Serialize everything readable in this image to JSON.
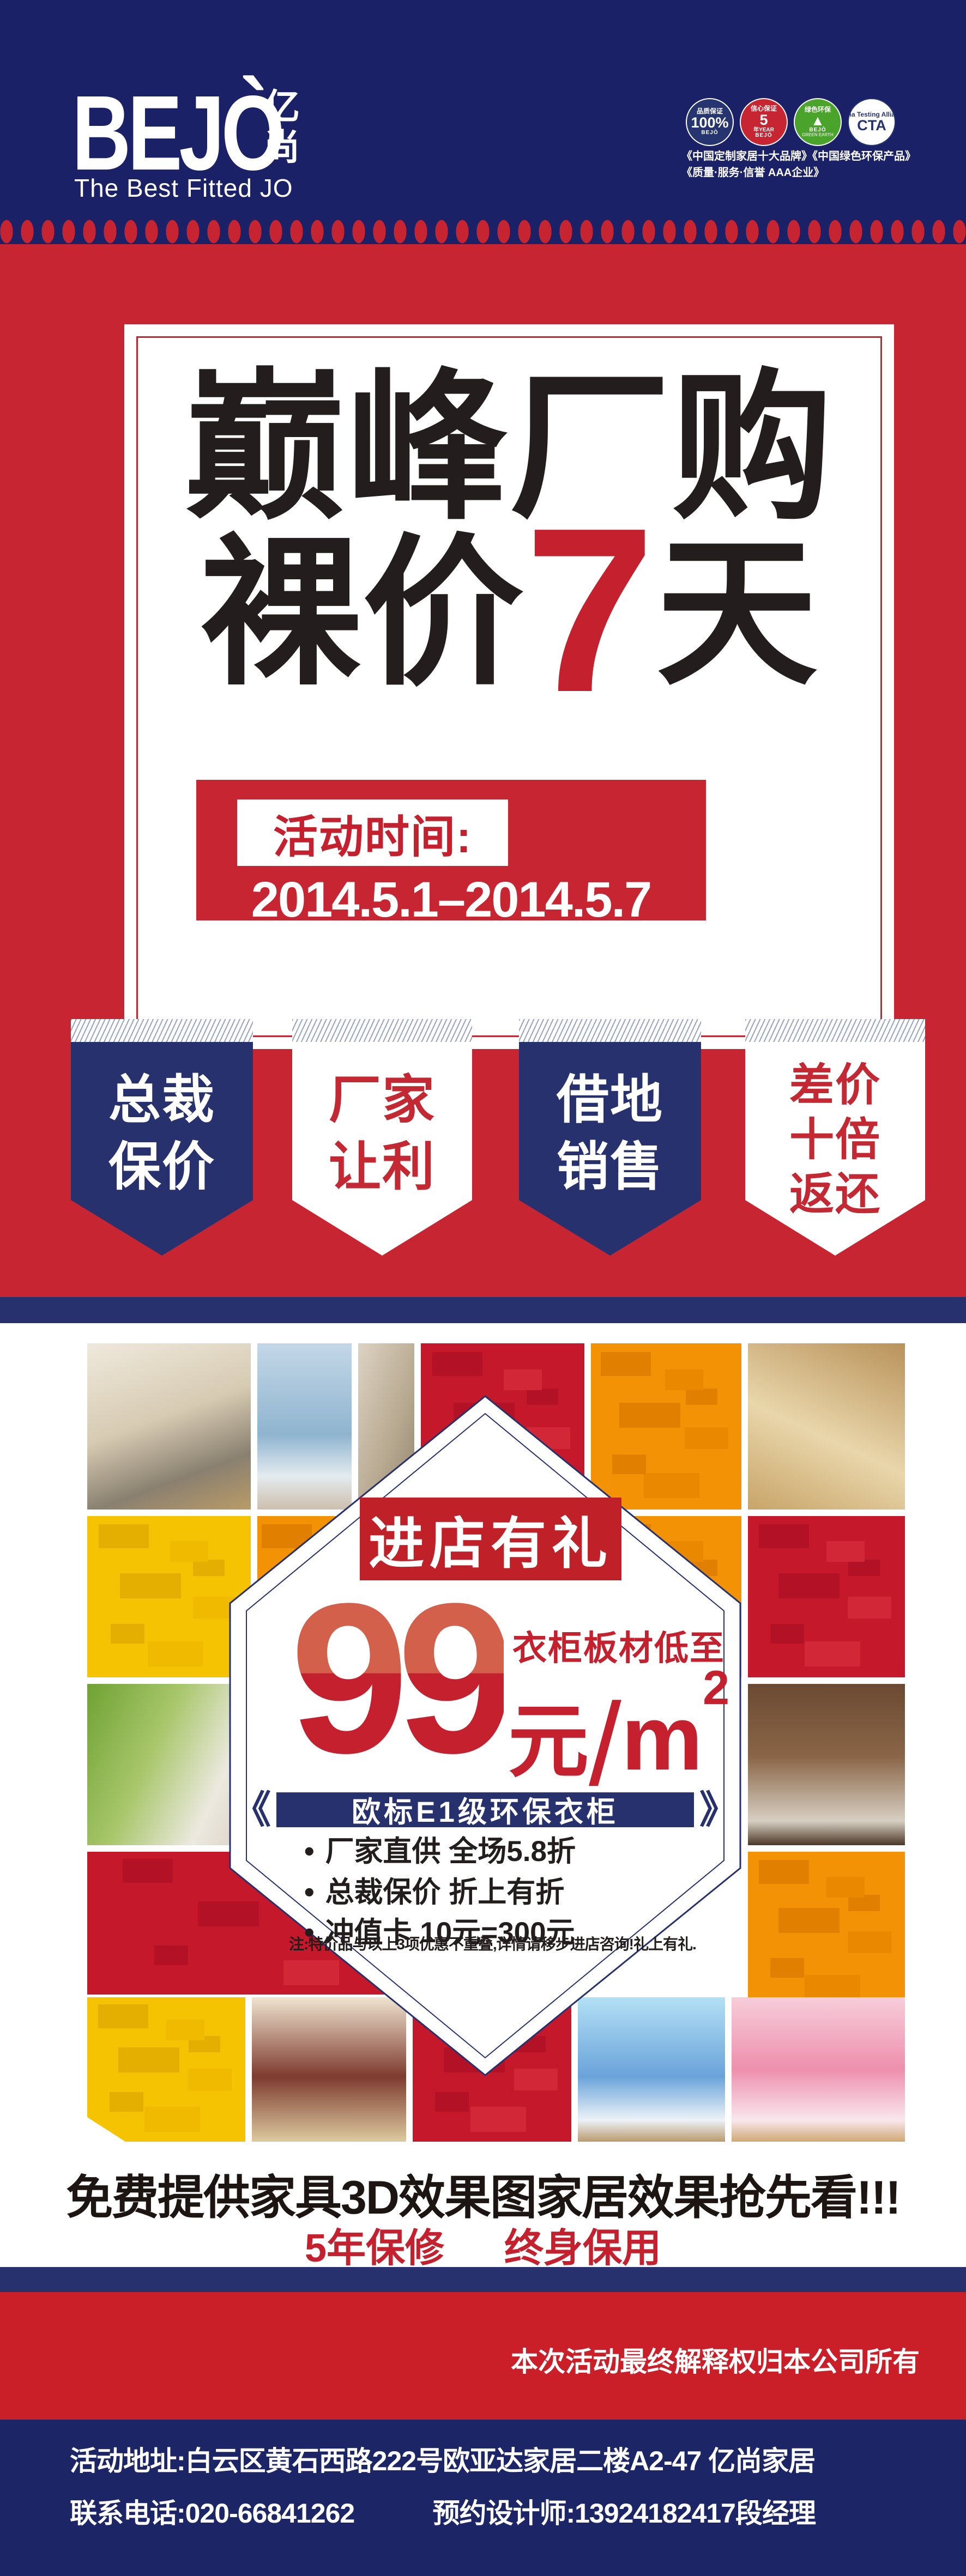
{
  "colors": {
    "navy": "#1b2166",
    "pennant_navy": "#27316e",
    "red": "#c62531",
    "accent_red": "#c5202e",
    "price_top": "#d2604a",
    "yellow": "#f6c303",
    "orange": "#f39204",
    "mosaic_red": "#c5182b",
    "green_badge": "#4aa32b"
  },
  "header": {
    "logo": {
      "word": "BEJÒ",
      "cn_top": "亿",
      "cn_bottom": "尚",
      "slogan": "The Best Fitted JO"
    },
    "badges": {
      "b1": {
        "top": "品质保证",
        "main": "100%",
        "brand": "BEJÒ"
      },
      "b2": {
        "top": "信心保证",
        "main": "5",
        "suffix": "年YEAR",
        "brand": "BEJÒ"
      },
      "b3": {
        "top": "绿色环保",
        "tree": "▲",
        "brand": "BEJÒ",
        "bottom": "GREEN EARTH"
      },
      "b4": {
        "top": "China Testing Alliance",
        "main": "CTA"
      }
    },
    "creds": {
      "line1": "《中国定制家居十大品牌》《中国绿色环保产品》",
      "line2": "《质量·服务·信誉 AAA企业》"
    }
  },
  "hero": {
    "title_line1": "巅峰厂购",
    "title_line2_pre": "裸价",
    "title_line2_num": "7",
    "title_line2_post": "天",
    "time_label": "活动时间:",
    "dates": "2014.5.1–2014.5.7"
  },
  "pennants": [
    {
      "line1": "总裁",
      "line2": "保价",
      "line3": ""
    },
    {
      "line1": "厂家",
      "line2": "让利",
      "line3": ""
    },
    {
      "line1": "借地",
      "line2": "销售",
      "line3": ""
    },
    {
      "line1": "差价",
      "line2": "十倍",
      "line3": "返还"
    }
  ],
  "offer": {
    "banner": "进店有礼",
    "price": "99",
    "tagline": "衣柜板材低至",
    "yuan": "元",
    "slash": "/",
    "meter": "m",
    "sup": "2",
    "quote_left": "《",
    "bar": "欧标E1级环保衣柜",
    "quote_right": "》",
    "bullet": "•",
    "bullets": [
      "厂家直供  全场5.8折",
      "总裁保价  折上有折",
      "冲值卡  10元=300元"
    ],
    "note": "注:特价品与以上3项优惠不重叠,详情请移步进店咨询!礼上有礼."
  },
  "promo": {
    "line1": "免费提供家具3D效果图家居效果抢先看!!!",
    "warranty1": "5年保修",
    "warranty2": "终身保用"
  },
  "disclaimer": "本次活动最终解释权归本公司所有",
  "footer": {
    "line1": "活动地址:白云区黄石西路222号欧亚达家居二楼A2-47  亿尚家居",
    "line2_left": "联系电话:020-66841262",
    "line2_right": "预约设计师:13924182417段经理"
  }
}
